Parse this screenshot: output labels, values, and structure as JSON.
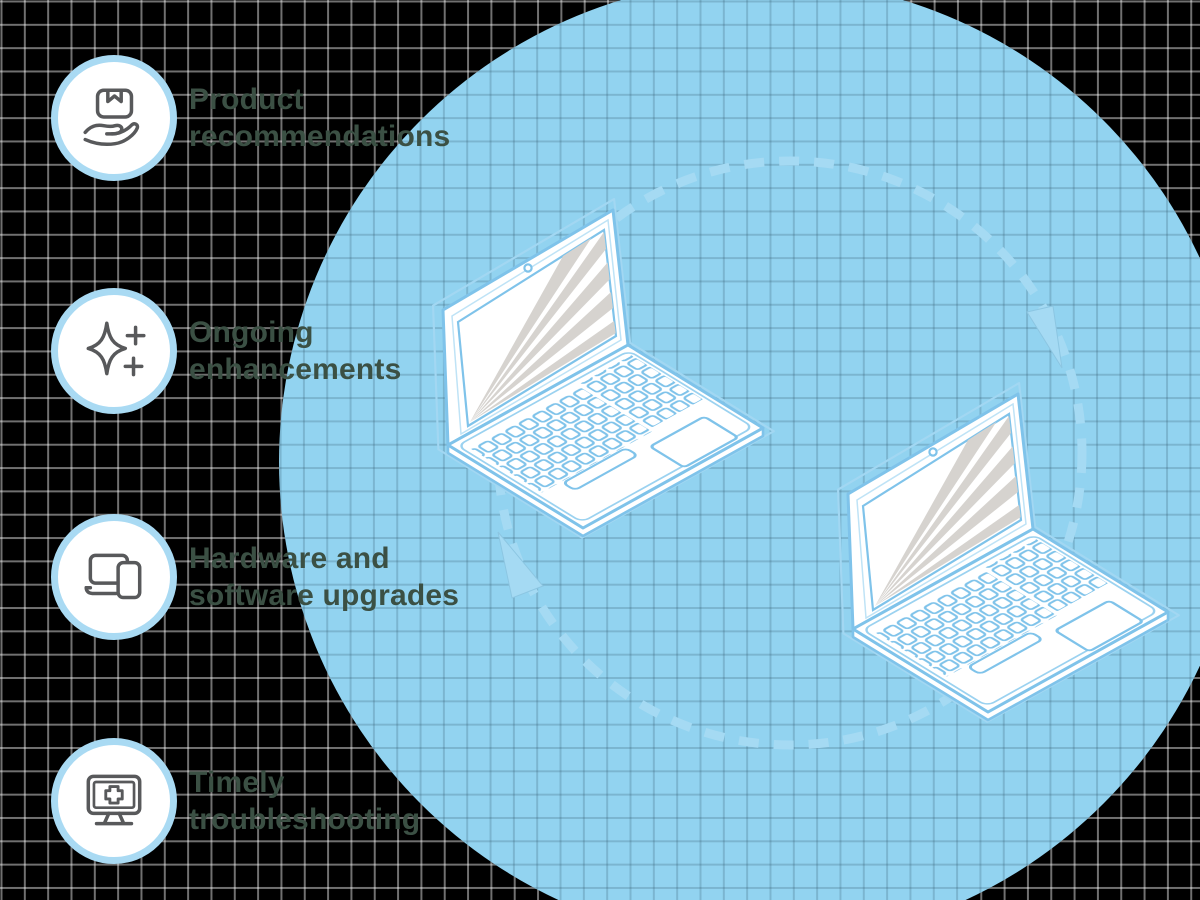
{
  "features": [
    {
      "icon": "box-in-hand-icon",
      "lines": [
        "Product",
        "recommendations"
      ]
    },
    {
      "icon": "sparkle-plus-icon",
      "lines": [
        "Ongoing",
        "enhancements"
      ]
    },
    {
      "icon": "laptop-tablet-icon",
      "lines": [
        "Hardware and",
        "software upgrades"
      ]
    },
    {
      "icon": "monitor-cross-icon",
      "lines": [
        "Timely",
        "troubleshooting"
      ]
    }
  ],
  "cycle": {
    "laptop_count": 2,
    "arrow_count": 2,
    "direction": "clockwise"
  },
  "colors": {
    "background": "#000000",
    "grid_line_on_black": "#707070",
    "circle_fill": "#92d3f0",
    "grid_line_on_blue": "#7fb6cf",
    "laptop_outline_blue": "#7fc3ea",
    "screen_ray_gray": "#d6d3cf",
    "dash_arrow_blue": "#a5daf3",
    "icon_ring_blue": "#a9daf3",
    "icon_stroke_gray": "#58595b",
    "label_green": "#3b5044"
  }
}
